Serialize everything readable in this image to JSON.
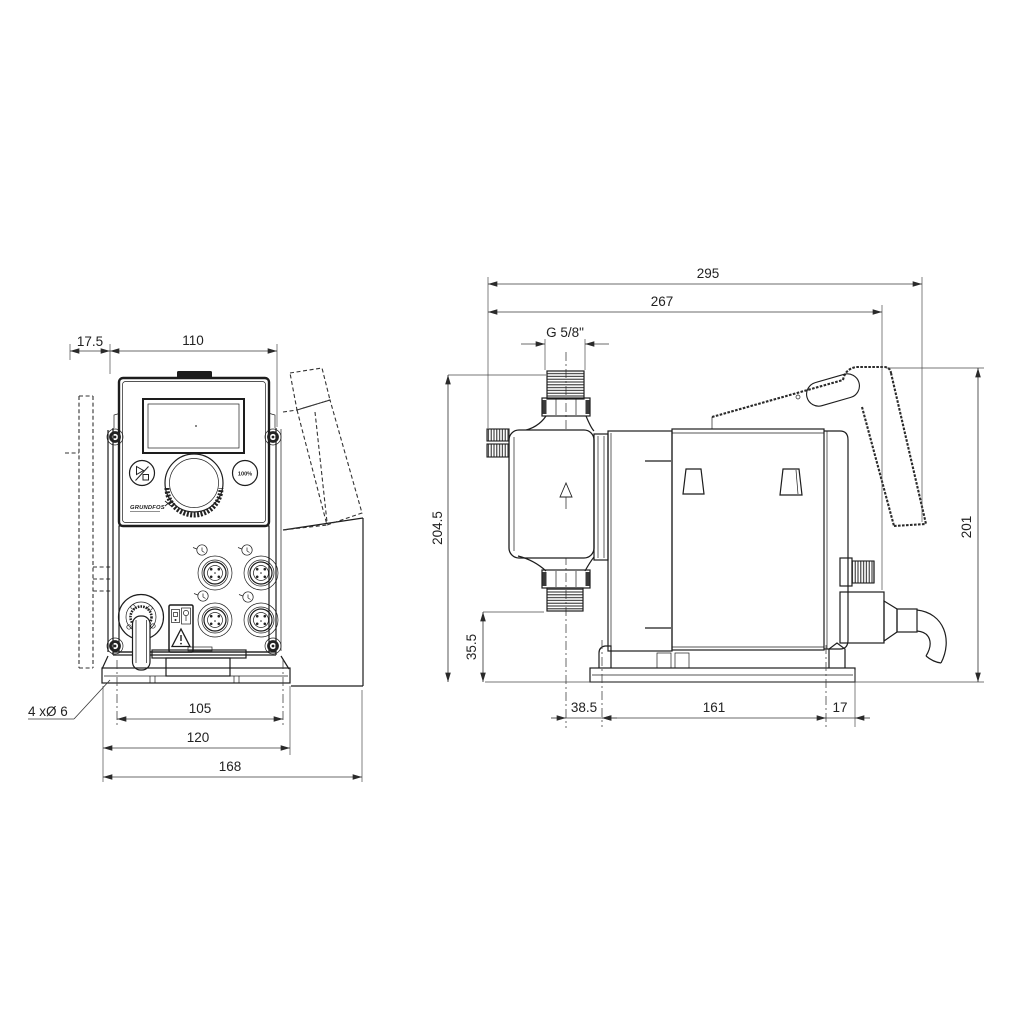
{
  "front": {
    "dims": {
      "offset_left": "17.5",
      "body_width": "110",
      "hole_spacing": "105",
      "plate_width": "120",
      "total_width": "168",
      "holes_label": "4 xØ 6"
    },
    "controls": {
      "max_button": "100%",
      "logo": "GRUNDFOS"
    }
  },
  "side": {
    "dims": {
      "total_length": "295",
      "length_to_gland": "267",
      "thread_label": "G 5/8\"",
      "height_total": "204.5",
      "valve_height": "35.5",
      "height_rear": "201",
      "head_offset": "38.5",
      "hole_spacing": "161",
      "edge_offset": "17"
    }
  }
}
